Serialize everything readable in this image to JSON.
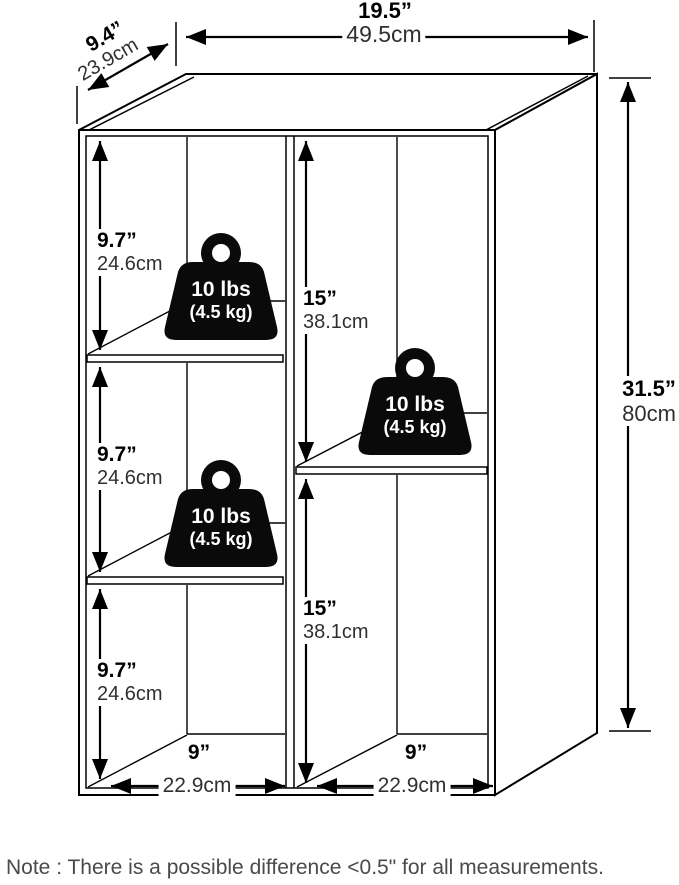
{
  "dimensions": {
    "top_width": {
      "inches": "19.5”",
      "cm": "49.5cm"
    },
    "depth": {
      "inches": "9.4”",
      "cm": "23.9cm"
    },
    "height": {
      "inches": "31.5”",
      "cm": "80cm"
    },
    "left_column_cells": [
      {
        "inches": "9.7”",
        "cm": "24.6cm"
      },
      {
        "inches": "9.7”",
        "cm": "24.6cm"
      },
      {
        "inches": "9.7”",
        "cm": "24.6cm"
      }
    ],
    "right_column_cells": [
      {
        "inches": "15”",
        "cm": "38.1cm"
      },
      {
        "inches": "15”",
        "cm": "38.1cm"
      }
    ],
    "cell_widths": [
      {
        "inches": "9”",
        "cm": "22.9cm"
      },
      {
        "inches": "9”",
        "cm": "22.9cm"
      }
    ]
  },
  "weights": [
    {
      "label": "10 lbs",
      "sublabel": "(4.5 kg)"
    },
    {
      "label": "10 lbs",
      "sublabel": "(4.5 kg)"
    },
    {
      "label": "10 lbs",
      "sublabel": "(4.5 kg)"
    }
  ],
  "note": "Note : There is a possible difference <0.5\" for all measurements.",
  "colors": {
    "line": "#000000",
    "inch_text": "#000000",
    "cm_text": "#303030",
    "note_text": "#4a4a4a",
    "weight_fill": "#0a0a0a",
    "background": "#ffffff"
  }
}
